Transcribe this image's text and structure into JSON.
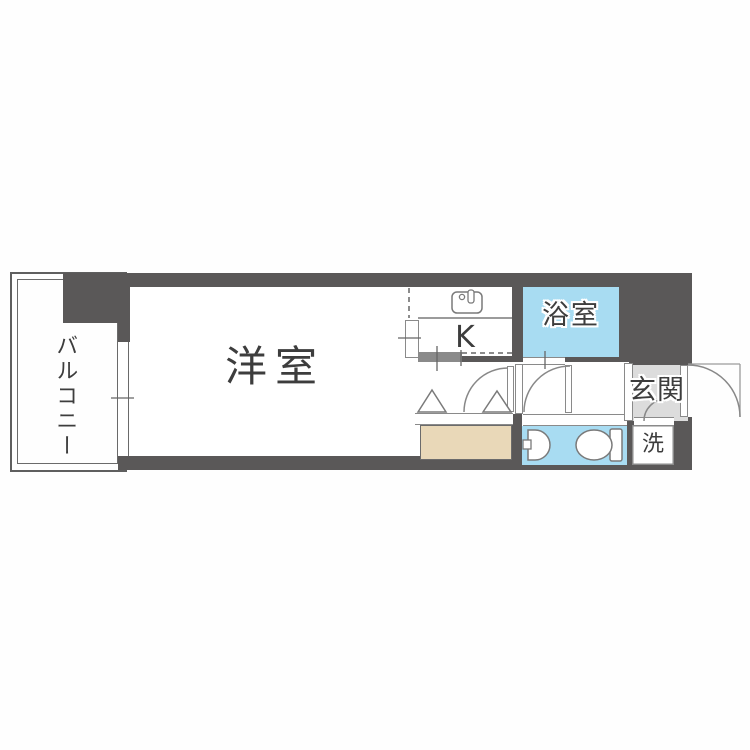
{
  "plan": {
    "title": "apartment-floor-plan",
    "rooms": {
      "balcony": {
        "label": "バルコニー"
      },
      "western_room": {
        "label": "洋室"
      },
      "kitchen": {
        "label": "K"
      },
      "bathroom": {
        "label": "浴室"
      },
      "entrance": {
        "label": "玄関"
      },
      "laundry": {
        "label": "洗"
      }
    },
    "colors": {
      "wall_gray": "#5a5858",
      "water_blue": "#a8dcf2",
      "closet_beige": "#e9d8b8",
      "entrance_gray": "#dcdcdc",
      "fixture_line_gray": "#7a7a7a",
      "text_gray": "#3d3d3d"
    }
  }
}
